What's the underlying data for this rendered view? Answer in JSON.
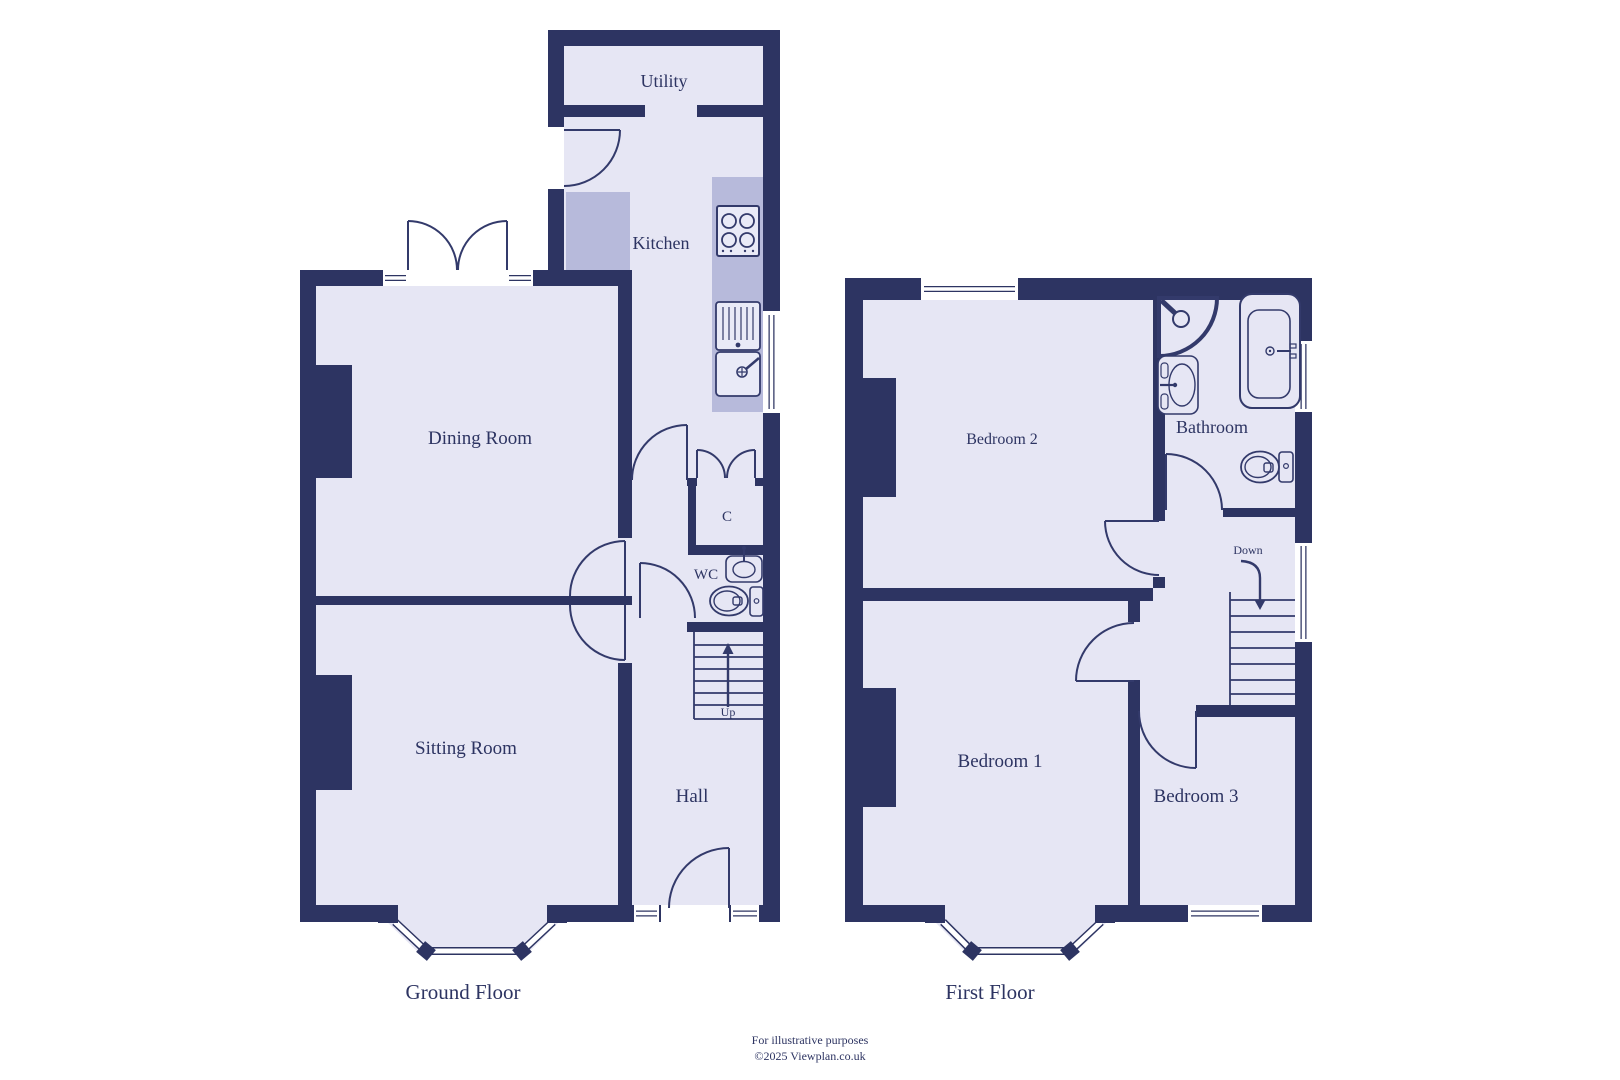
{
  "colors": {
    "wall": "#2d3462",
    "room": "#e6e6f4",
    "counter": "#b7badb",
    "stroke": "#333a6b",
    "text": "#2d3462",
    "window": "#ffffff",
    "fixture": "#e9eaf7"
  },
  "ground": {
    "title": "Ground Floor",
    "rooms": {
      "utility": "Utility",
      "kitchen": "Kitchen",
      "dining": "Dining Room",
      "sitting": "Sitting Room",
      "hall": "Hall",
      "cupboard": "C",
      "wc": "WC"
    },
    "stairs_label": "Up",
    "fixtures": [
      "hob",
      "sink",
      "wc-basin",
      "wc-toilet"
    ]
  },
  "first": {
    "title": "First Floor",
    "rooms": {
      "bedroom2": "Bedroom 2",
      "bathroom": "Bathroom",
      "bedroom1": "Bedroom 1",
      "bedroom3": "Bedroom 3"
    },
    "stairs_label": "Down",
    "fixtures": [
      "corner-shower",
      "basin",
      "bath",
      "toilet"
    ]
  },
  "footer": {
    "line1": "For illustrative purposes",
    "line2": "©2025 Viewplan.co.uk"
  }
}
